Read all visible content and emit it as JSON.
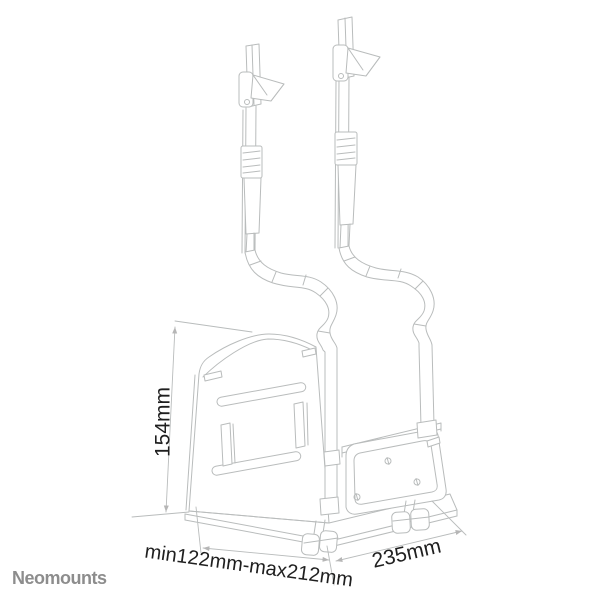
{
  "diagram": {
    "subject": "under-desk CPU holder with two hanging straps - technical line drawing",
    "line_color": "#b9bcbc",
    "label_color": "#1f1f1f",
    "dimensions": {
      "height": "154mm",
      "depth_range": "min122mm-max212mm",
      "width": "235mm"
    }
  },
  "brand": {
    "name": "Neomounts",
    "color": "#8d8d8d"
  },
  "background": "#ffffff"
}
